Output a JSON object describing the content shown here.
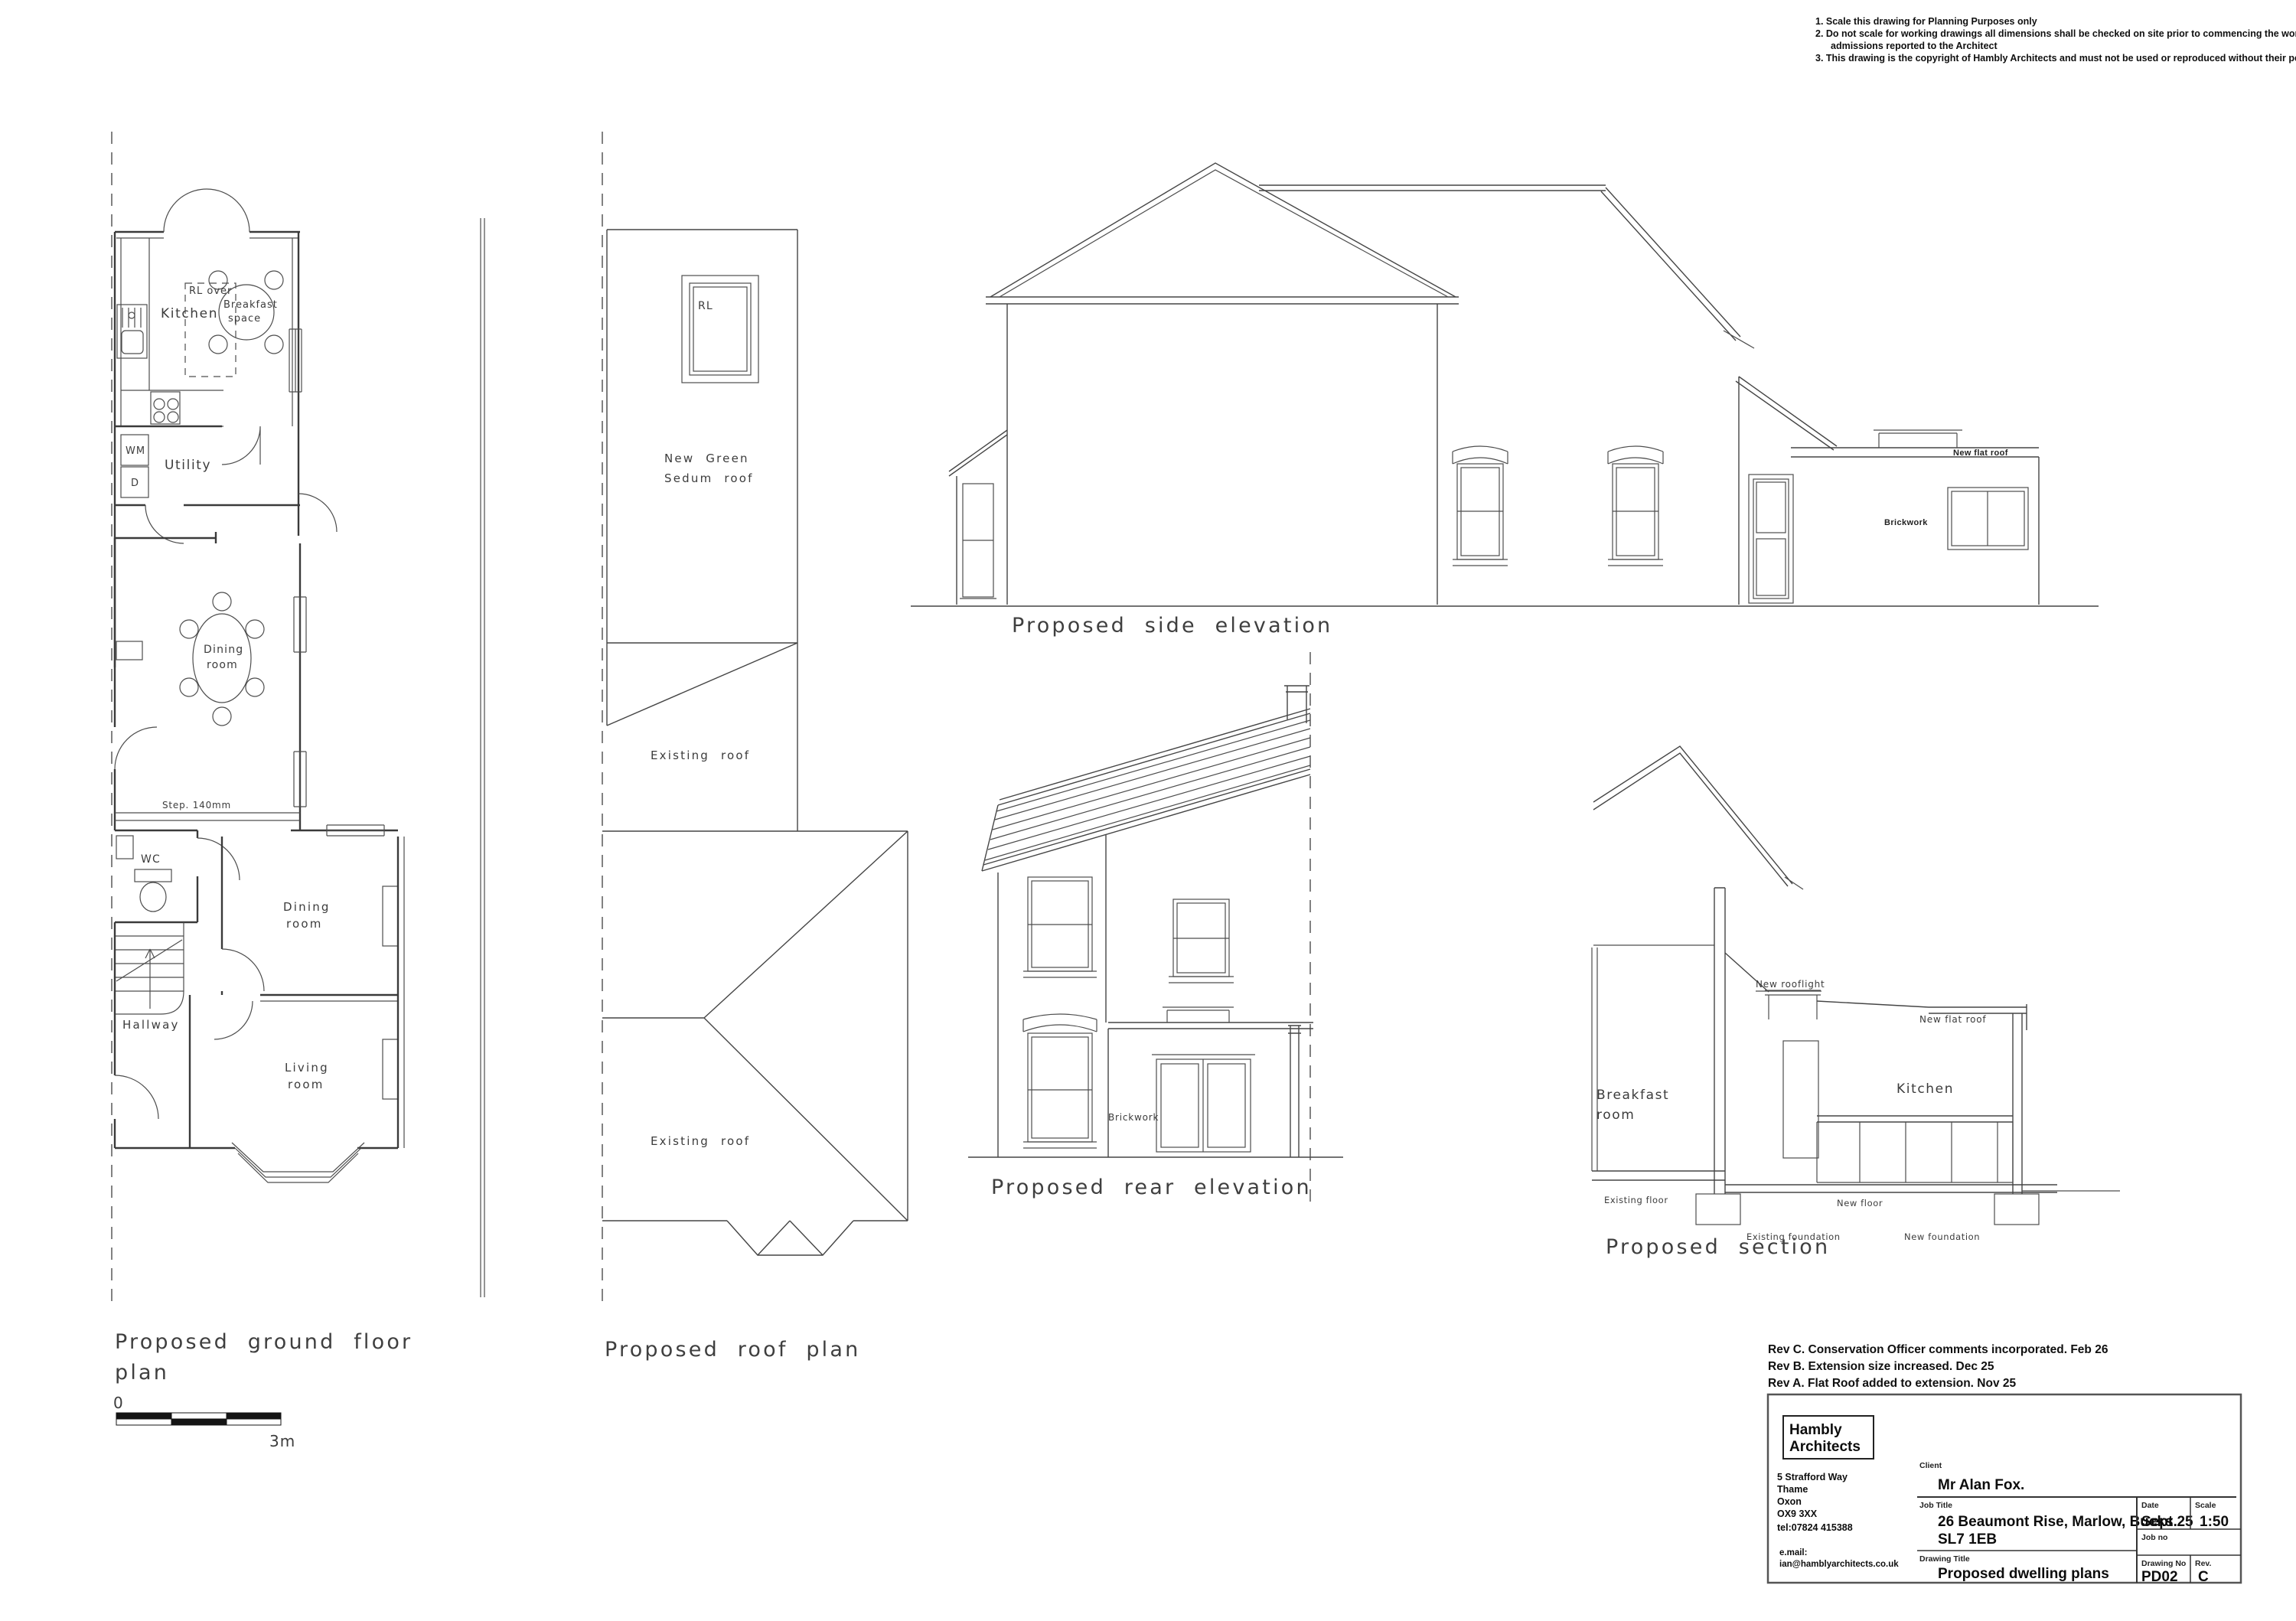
{
  "colors": {
    "ink": "#3a3a3a",
    "paper": "#ffffff"
  },
  "general_notes": {
    "line1": "1. Scale this drawing for Planning Purposes only",
    "line2": "2. Do not scale for working drawings all dimensions shall be checked on site prior to commencing the works and any errors or",
    "line3": "admissions reported to the Architect",
    "line4": "3. This drawing is the copyright of Hambly Architects and must not be used or reproduced without their permission"
  },
  "floor_plan": {
    "caption_line1": "Proposed ground floor",
    "caption_line2": "plan",
    "kitchen": "Kitchen",
    "rl_over": "RL over",
    "breakfast_line1": "Breakfast",
    "breakfast_line2": "space",
    "utility": "Utility",
    "wm": "WM",
    "dryer": "D",
    "dining_mid_line1": "Dining",
    "dining_mid_line2": "room",
    "step_note": "Step. 140mm",
    "wc": "WC",
    "dining_front_line1": "Dining",
    "dining_front_line2": "room",
    "hallway": "Hallway",
    "living_line1": "Living",
    "living_line2": "room"
  },
  "scale_bar": {
    "start": "0",
    "end": "3m"
  },
  "roof_plan": {
    "caption": "Proposed roof plan",
    "rooflight": "RL",
    "sedum_line1": "New Green",
    "sedum_line2": "Sedum roof",
    "existing_roof_upper": "Existing roof",
    "existing_roof_lower": "Existing roof"
  },
  "side_elevation": {
    "caption": "Proposed side elevation",
    "new_flat_roof": "New flat roof",
    "brickwork": "Brickwork"
  },
  "rear_elevation": {
    "caption": "Proposed rear elevation",
    "brickwork": "Brickwork"
  },
  "section": {
    "caption": "Proposed section",
    "breakfast_line1": "Breakfast",
    "breakfast_line2": "room",
    "kitchen": "Kitchen",
    "new_rooflight": "New rooflight",
    "new_flat_roof": "New flat roof",
    "existing_floor": "Existing floor",
    "new_floor": "New floor",
    "existing_foundation": "Existing foundation",
    "new_foundation": "New foundation"
  },
  "revisions": {
    "rev_c": "Rev C. Conservation Officer comments incorporated. Feb 26",
    "rev_b": "Rev B. Extension size increased. Dec 25",
    "rev_a": "Rev A. Flat Roof added to extension. Nov 25"
  },
  "title_block": {
    "company_line1": "Hambly",
    "company_line2": "Architects",
    "address_line1": "5 Strafford Way",
    "address_line2": "Thame",
    "address_line3": "Oxon",
    "address_line4": "OX9 3XX",
    "address_line5": "tel:07824 415388",
    "email_label": "e.mail:",
    "email": "ian@hamblyarchitects.co.uk",
    "client_label": "Client",
    "client": "Mr Alan Fox.",
    "job_title_label": "Job Title",
    "job_title_line1": "26 Beaumont Rise, Marlow, Bucks.",
    "job_title_line2": "SL7 1EB",
    "date_label": "Date",
    "date": "Sept 25",
    "scale_label": "Scale",
    "scale": "1:50",
    "job_no_label": "Job no",
    "drawing_title_label": "Drawing Title",
    "drawing_title": "Proposed dwelling plans",
    "drawing_no_label": "Drawing No",
    "drawing_no": "PD02",
    "rev_label": "Rev.",
    "rev": "C"
  }
}
